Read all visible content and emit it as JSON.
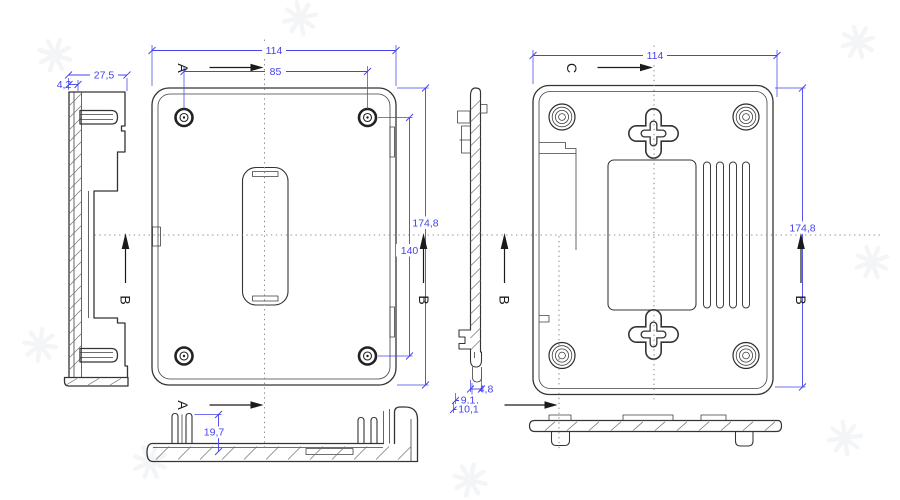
{
  "drawing": {
    "title": "enclosure-orthographic-views",
    "colors": {
      "dimension_blue": "#4343ee",
      "part_lines": "#343434",
      "centerline_gray": "#8b8b8b",
      "view_label_black": "#1b1b1b"
    },
    "view_labels": {
      "a_top": "A",
      "a_bottom": "A",
      "c_top": "C",
      "b_left_side": "B",
      "b_front": "B",
      "b_profile": "B",
      "b_back": "B"
    },
    "dimensions": {
      "front": {
        "overall_width": "114",
        "hole_spacing_width": "85",
        "overall_height": "174,8",
        "hole_spacing_height": "140"
      },
      "left_side": {
        "top_depth": "27,5",
        "wall_thickness": "4,2"
      },
      "front_bottom": {
        "post_height": "19,7"
      },
      "back_profile": {
        "hook_width": "4,8",
        "inner_depth": "9,1",
        "overall_depth": "10,1"
      },
      "back": {
        "overall_width": "114",
        "overall_height": "174,8"
      }
    }
  }
}
